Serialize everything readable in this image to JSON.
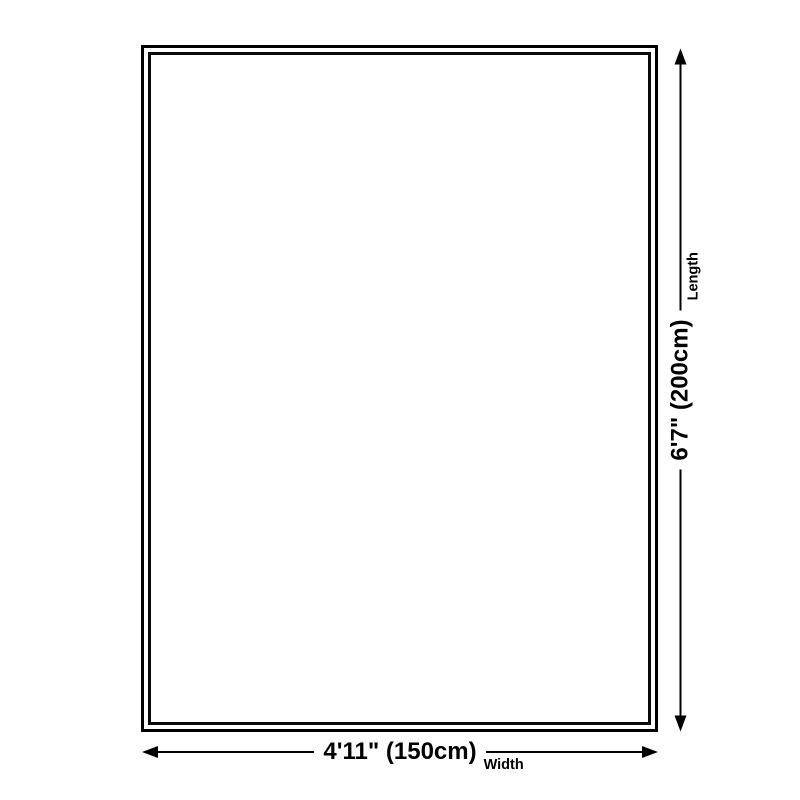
{
  "diagram": {
    "length": {
      "value": "6'7\" (200cm)",
      "label": "Length"
    },
    "width": {
      "value": "4'11\" (150cm)",
      "label": "Width"
    },
    "colors": {
      "line": "#000000",
      "border": "#000000",
      "background": "#ffffff"
    },
    "icons": {
      "vertical_start": "arrow-down-icon",
      "vertical_end": "arrow-up-icon",
      "horizontal_start": "arrow-left-icon",
      "horizontal_end": "arrow-right-icon"
    }
  }
}
